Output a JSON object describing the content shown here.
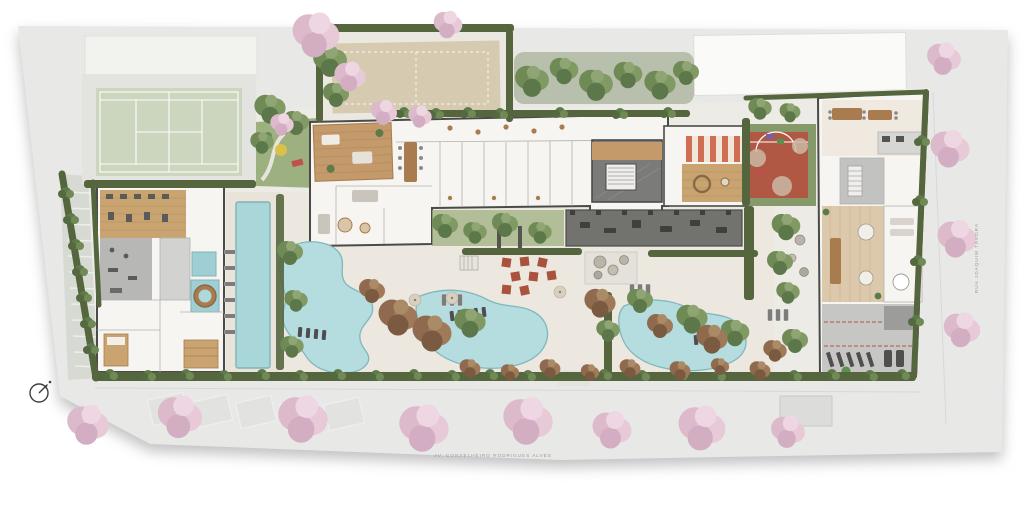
{
  "plan": {
    "type": "architectural-site-plan",
    "streets": {
      "bottom": {
        "label": "AV. CONSELHEIRO RODRIGUES ALVES"
      },
      "right": {
        "label": "RUA JOAQUIM TÁVORA"
      }
    },
    "compass": {
      "icon": "north-arrow-icon"
    },
    "palette": {
      "street_gray": "#e8e8e6",
      "site_paving": "#edebe5",
      "pool_deck": "#ece7dd",
      "building_floor": "#f7f5f2",
      "wall": "#4a4a48",
      "wood": "#c49a6a",
      "wood_dark": "#a87c4e",
      "lawn": "#9db07f",
      "hedge": "#55663f",
      "tree_green": "#6f8a55",
      "tree_pink": "#e3c3d2",
      "tree_brown": "#8f6a4e",
      "pool_water": "#aed9db",
      "pool_edge": "#7fb8bc",
      "tennis_court": "#ccd6bf",
      "sand_court": "#d6cbb0",
      "sport_red": "#b05844",
      "kids_deck_red": "#cf6e52",
      "gray_zone": "#c6c6c4",
      "dark_zone": "#72726f",
      "label_text": "#9b9b99"
    },
    "zones": [
      "tennis-court",
      "beach-tennis-court",
      "kids-lawn-playground",
      "lounge-deck",
      "gourmet-dining-room",
      "residential-corridor",
      "lobby",
      "kids-playroom-deck",
      "playground",
      "basketball-half-court",
      "outdoor-fitness-area",
      "courtyard-dining-terrace",
      "zen-garden",
      "gym",
      "functional-training-area",
      "spa-pools",
      "round-hot-tub",
      "massage-room",
      "sauna",
      "lap-pool",
      "leisure-pool-west",
      "leisure-pool-center",
      "leisure-pool-east",
      "party-rooms",
      "gourmet-kitchen",
      "coworking-lounge",
      "bike-storage",
      "garage-ramp",
      "neighbor-building",
      "sidewalk-cherry-trees"
    ]
  }
}
